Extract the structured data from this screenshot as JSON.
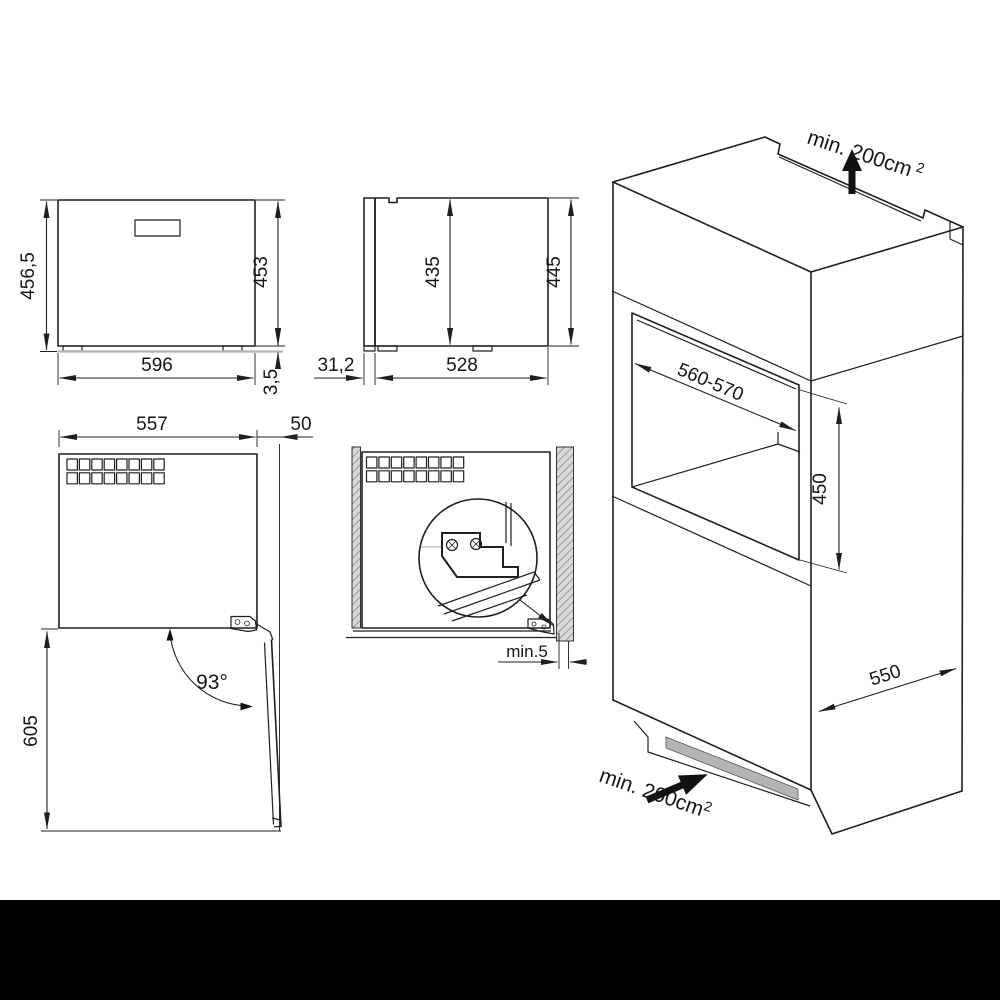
{
  "front": {
    "total_height": "456,5",
    "body_height": "453",
    "width": "596",
    "feet_height": "3,5"
  },
  "side": {
    "inner_height": "435",
    "total_height": "445",
    "door_thickness": "31,2",
    "depth": "528"
  },
  "top_open": {
    "width": "557",
    "clearance": "50",
    "angle": "93°",
    "open_depth": "605"
  },
  "installed": {
    "gap": "min.5"
  },
  "niche": {
    "width": "560-570",
    "height": "450",
    "depth": "550"
  },
  "vent_top": {
    "label": "min. 200cm",
    "sup": "2"
  },
  "vent_bottom": {
    "label": "min. 200cm",
    "sup": "2"
  }
}
